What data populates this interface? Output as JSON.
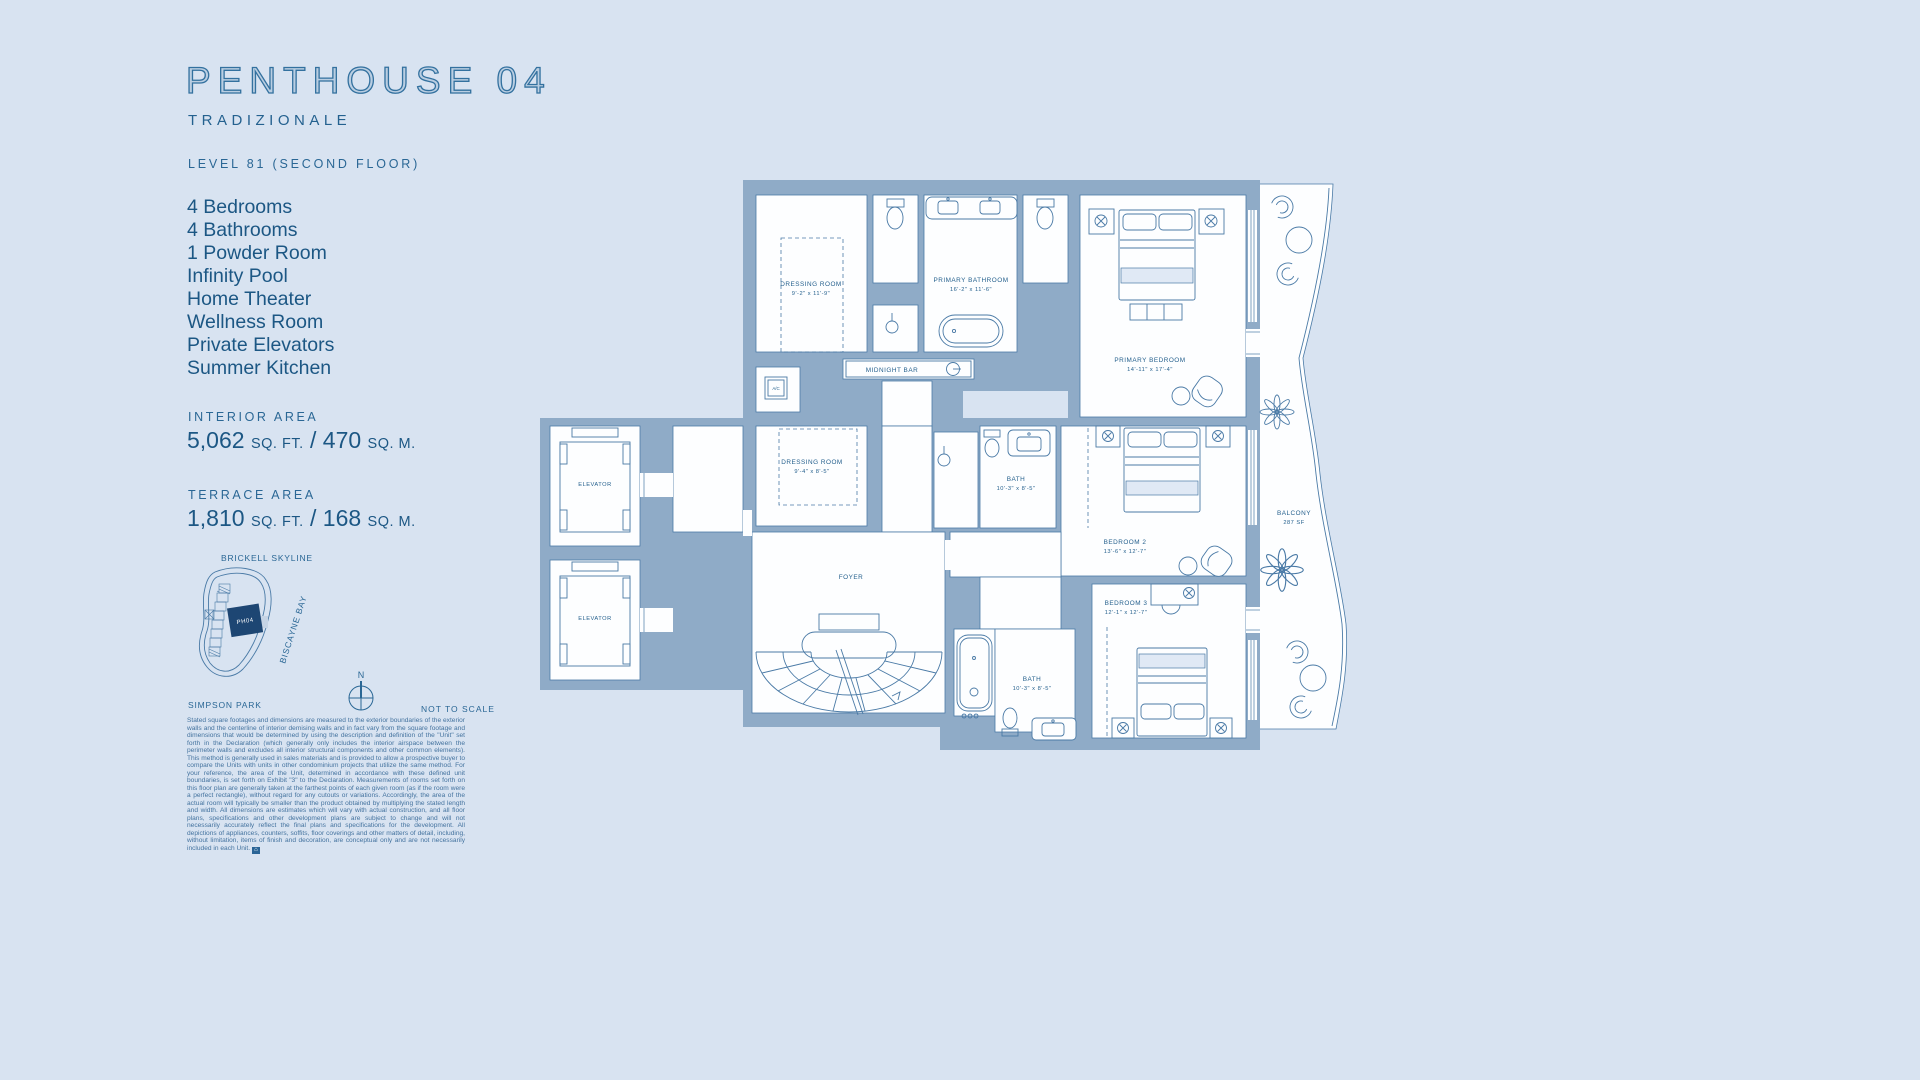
{
  "header": {
    "title": "PENTHOUSE 04",
    "collection": "TRADIZIONALE",
    "level": "LEVEL 81 (SECOND FLOOR)"
  },
  "features": [
    "4 Bedrooms",
    "4 Bathrooms",
    "1 Powder Room",
    "Infinity Pool",
    "Home Theater",
    "Wellness Room",
    "Private Elevators",
    "Summer Kitchen"
  ],
  "areas": {
    "interior": {
      "label": "INTERIOR AREA",
      "imperial": "5,062",
      "imperial_unit": "SQ. FT.",
      "separator": "/",
      "metric": "470",
      "metric_unit": "SQ. M."
    },
    "terrace": {
      "label": "TERRACE AREA",
      "imperial": "1,810",
      "imperial_unit": "SQ. FT.",
      "separator": "/",
      "metric": "168",
      "metric_unit": "SQ. M."
    }
  },
  "key_plan": {
    "skyline_label": "BRICKELL SKYLINE",
    "park_label": "SIMPSON PARK",
    "bay_label": "BISCAYNE BAY",
    "unit_label": "PH04",
    "compass_label": "N",
    "scale_note": "NOT TO SCALE"
  },
  "floor_plan": {
    "rooms": [
      {
        "name": "DRESSING ROOM",
        "dims": "9'-2\" x 11'-9\""
      },
      {
        "name": "PRIMARY BATHROOM",
        "dims": "16'-2\" x 11'-6\""
      },
      {
        "name": "PRIMARY BEDROOM",
        "dims": "14'-11\" x 17'-4\""
      },
      {
        "name": "MIDNIGHT BAR"
      },
      {
        "name": "A/C"
      },
      {
        "name": "ELEVATOR"
      },
      {
        "name": "DRESSING ROOM",
        "dims": "9'-4\" x 8'-5\""
      },
      {
        "name": "BATH",
        "dims": "10'-3\" x 8'-5\""
      },
      {
        "name": "BEDROOM 2",
        "dims": "13'-6\" x 12'-7\""
      },
      {
        "name": "BALCONY",
        "dims": "287 SF"
      },
      {
        "name": "FOYER"
      },
      {
        "name": "ELEVATOR"
      },
      {
        "name": "BEDROOM 3",
        "dims": "12'-1\" x 12'-7\""
      },
      {
        "name": "BATH",
        "dims": "10'-3\" x 8'-5\""
      }
    ]
  },
  "disclaimer": "Stated square footages and dimensions are measured to the exterior boundaries of the exterior walls and the centerline of interior demising walls and in fact vary from the square footage and dimensions that would be determined by using the description and definition of the \"Unit\" set forth in the Declaration (which generally only includes the interior airspace between the perimeter walls and excludes all interior structural components and other common elements). This method is generally used in sales materials and is provided to allow a prospective buyer to compare the Units with units in other condominium projects that utilize the same method. For your reference, the area of the Unit, determined in accordance with these defined unit boundaries, is set forth on Exhibit \"3\" to the Declaration. Measurements of rooms set forth on this floor plan are generally taken at the farthest points of each given room (as if the room were a perfect rectangle), without regard for any cutouts or variations. Accordingly, the area of the actual room will typically be smaller than the product obtained by multiplying the stated length and width.  All dimensions are estimates which will vary with actual construction, and all floor plans, specifications and other development plans are subject to change and will not necessarily accurately reflect the final plans and specifications for the development. All depictions of appliances, counters, soffits, floor coverings and other matters of detail, including, without limitation, items of finish and decoration, are conceptual only and are not necessarily included in each Unit."
}
